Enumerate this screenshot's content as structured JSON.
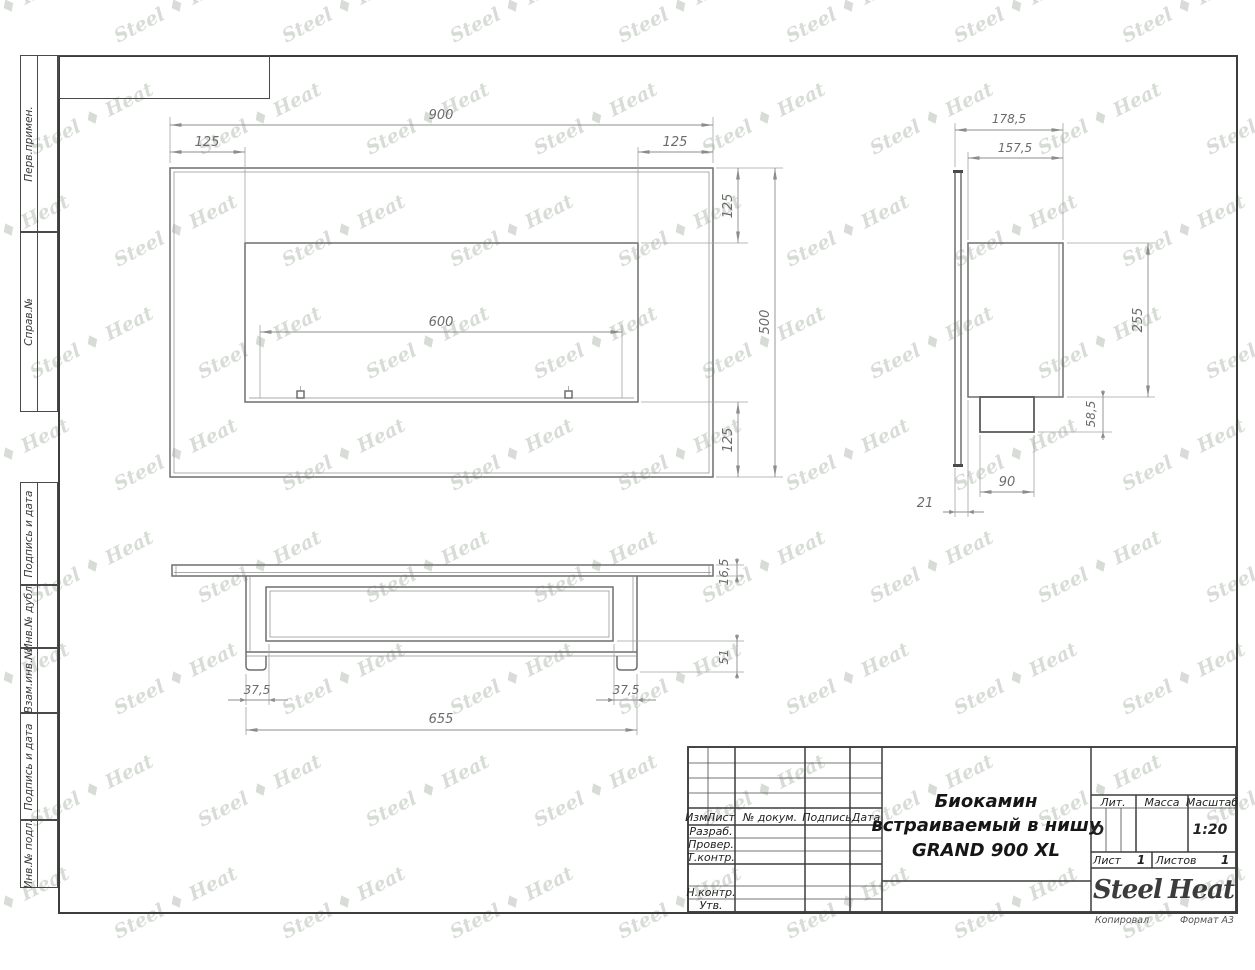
{
  "margin_labels": [
    "Перв.примен.",
    "Справ.№",
    "Подпись и дата",
    "Инв.№ дубл.",
    "Взам.инв.№",
    "Подпись и дата",
    "Инв.№ подл."
  ],
  "watermark": {
    "text": "Steel ♦ Heat"
  },
  "dims": {
    "front": {
      "width": "900",
      "left_inset": "125",
      "right_inset": "125",
      "burner": "600",
      "top_inset": "125",
      "height": "500",
      "bottom_inset": "125"
    },
    "side": {
      "total_depth": "178,5",
      "body_depth": "157,5",
      "body_height": "255",
      "burner_height": "58,5",
      "burner_depth": "90",
      "flange_offset": "21"
    },
    "bottom": {
      "flange_thickness": "16,5",
      "depth": "51",
      "left_inset": "37,5",
      "right_inset": "37,5",
      "body_width": "655"
    }
  },
  "title_block": {
    "cols": {
      "izm": "Изм.",
      "list": "Лист",
      "doc": "№ докум.",
      "podpis": "Подпись",
      "data": "Дата"
    },
    "rows": {
      "razrab": "Разраб.",
      "prover": "Провер.",
      "tkontr": "Т.контр.",
      "nkontr": "Н.контр.",
      "utv": "Утв."
    },
    "title_line1": "Биокамин",
    "title_line2": "встраиваемый в нишу",
    "title_line3": "GRAND 900 XL",
    "lit_label": "Лит.",
    "lit_value": "О",
    "massa_label": "Масса",
    "scale_label": "Масштаб",
    "scale_value": "1:20",
    "sheet_label": "Лист",
    "sheet_value": "1",
    "sheets_label": "Листов",
    "sheets_value": "1",
    "kopiroval": "Копировал",
    "format": "Формат А3"
  },
  "logo": {
    "steel": "Steel",
    "heat": "Heat"
  }
}
